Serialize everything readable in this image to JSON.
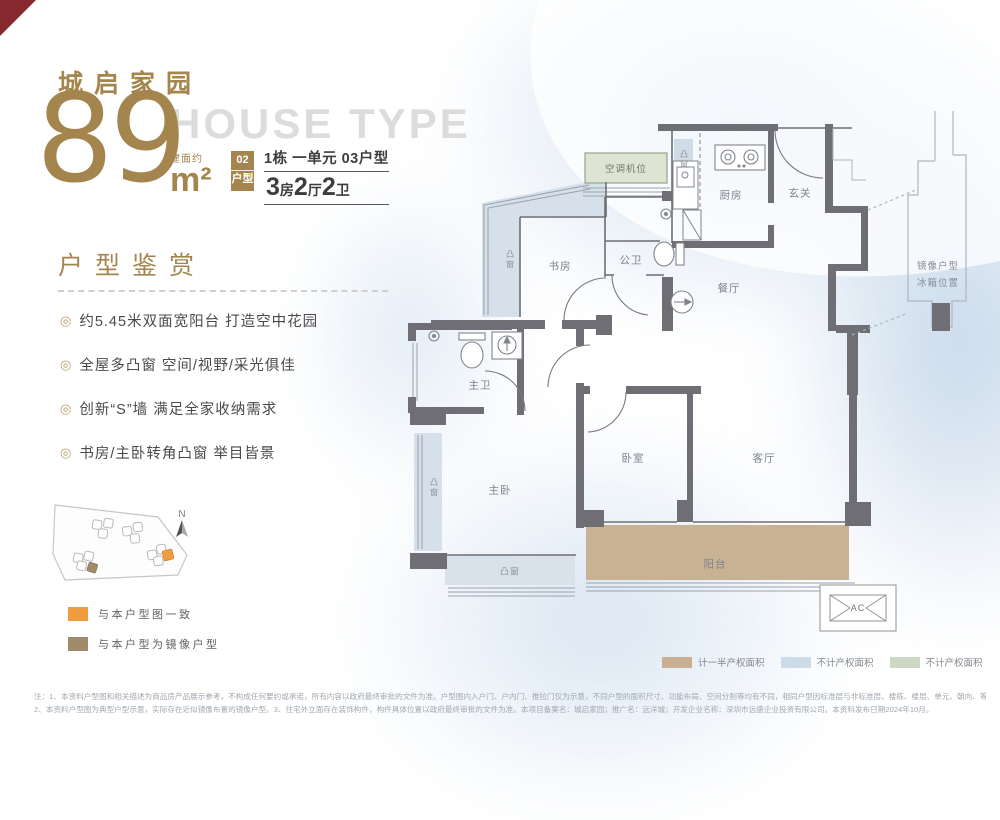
{
  "header": {
    "project_name": "城启家园",
    "area_number": "89",
    "area_prefix": "建面约",
    "area_unit": "m²",
    "house_type_en": "HOUSE TYPE",
    "unit_badge_line1": "02",
    "unit_badge_line2": "户型",
    "unit_location": "1栋 一单元 03户型",
    "layout_parts": [
      {
        "num": "3",
        "unit": "房"
      },
      {
        "num": "2",
        "unit": "厅"
      },
      {
        "num": "2",
        "unit": "卫"
      }
    ]
  },
  "appreciation": {
    "title": "户型鉴赏",
    "bullet": "◎",
    "features": [
      "约5.45米双面宽阳台 打造空中花园",
      "全屋多凸窗 空间/视野/采光俱佳",
      "创新“S”墙 满足全家收纳需求",
      "书房/主卧转角凸窗 举目皆景"
    ]
  },
  "site_plan": {
    "north_label": "N",
    "legend": [
      {
        "label": "与本户型图一致",
        "color": "#EF9C3F"
      },
      {
        "label": "与本户型为镜像户型",
        "color": "#A08A69"
      }
    ]
  },
  "floor_plan": {
    "rooms": {
      "ac_slot": "空调机位",
      "kitchen": "厨房",
      "entry": "玄关",
      "public_bath": "公卫",
      "study": "书房",
      "dining": "餐厅",
      "master_bath": "主卫",
      "master_bedroom": "主卧",
      "bedroom": "卧室",
      "living": "客厅",
      "balcony": "阳台",
      "ac_outdoor": "AC"
    },
    "bay_window_label": "凸窗",
    "mirror_note_line1": "镜像户型",
    "mirror_note_line2": "冰箱位置"
  },
  "area_legend": [
    {
      "label": "计一半产权面积",
      "color": "#C9B092"
    },
    {
      "label": "不计产权面积",
      "color": "#CCDBE8"
    },
    {
      "label": "不计产权面积",
      "color": "#CDD8C4"
    }
  ],
  "disclaimer": {
    "line1": "注：1、本资料户型图和相关描述为商品房产品展示参考，不构成任何要约或承诺，所有内容以政府最终审批的文件为准。户型图内入户门、户内门、推拉门仅为示意，不同户型的面积尺寸、功能布局、空间分割等均有不同，相同户型因标准层与非标准层、楼栋、楼层、单元、朝向、等差异，局部外观、结构、管道、尺寸、面积等也可能不同。",
    "line2": "2、本资料户型图为典型户型示意，实际存在近似镜像布置的镜像户型。3、住宅外立面存在装饰构件，构件具体位置以政府最终审批的文件为准。本项目备案名：城启家园；推广名：远洋城；开发企业名称：深圳市远盛企业投资有限公司。本资料发布日期2024年10月。"
  },
  "colors": {
    "bronze": "#A5854E",
    "wall": "#6E6E74",
    "bay_window_fill": "#D5E0EA",
    "balcony_fill": "#C9B193",
    "ac_slot_fill": "#DDE4D3",
    "corner_fold": "#87282E"
  }
}
